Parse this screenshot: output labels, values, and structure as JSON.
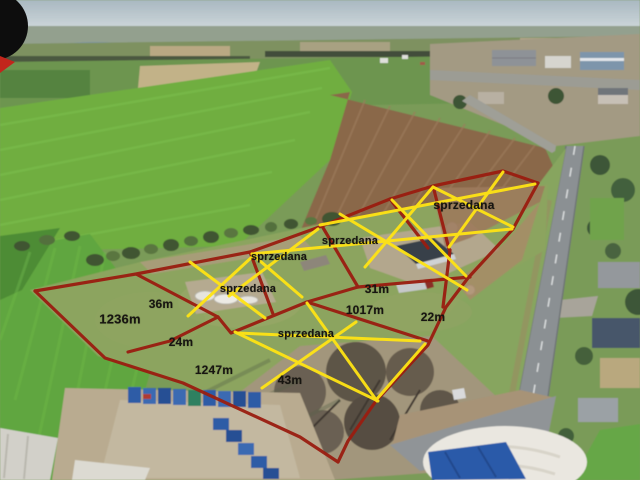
{
  "photo": {
    "kind": "aerial-drone-photo-of-building-plots",
    "sold_text": "sprzedana",
    "colors": {
      "plot_boundary_red": "#9a1d10",
      "sold_cross_yellow": "#ffe414",
      "label_text_black": "#171511",
      "watermark_black": "#0d0d0d",
      "watermark_red": "#c2251c"
    }
  },
  "plots": {
    "sold_plots": [
      {
        "label": "sprzedana",
        "x": 464,
        "y": 205
      },
      {
        "label": "sprzedana",
        "x": 350,
        "y": 241
      },
      {
        "label": "sprzedana",
        "x": 279,
        "y": 257
      },
      {
        "label": "sprzedana",
        "x": 248,
        "y": 289
      },
      {
        "label": "sprzedana",
        "x": 306,
        "y": 334
      }
    ],
    "dimensions": [
      {
        "label": "36m",
        "x": 161,
        "y": 304
      },
      {
        "label": "1236m",
        "x": 120,
        "y": 319
      },
      {
        "label": "24m",
        "x": 181,
        "y": 342
      },
      {
        "label": "1247m",
        "x": 214,
        "y": 370
      },
      {
        "label": "43m",
        "x": 290,
        "y": 380
      },
      {
        "label": "31m",
        "x": 377,
        "y": 289
      },
      {
        "label": "1017m",
        "x": 365,
        "y": 310
      },
      {
        "label": "22m",
        "x": 433,
        "y": 317
      }
    ]
  }
}
